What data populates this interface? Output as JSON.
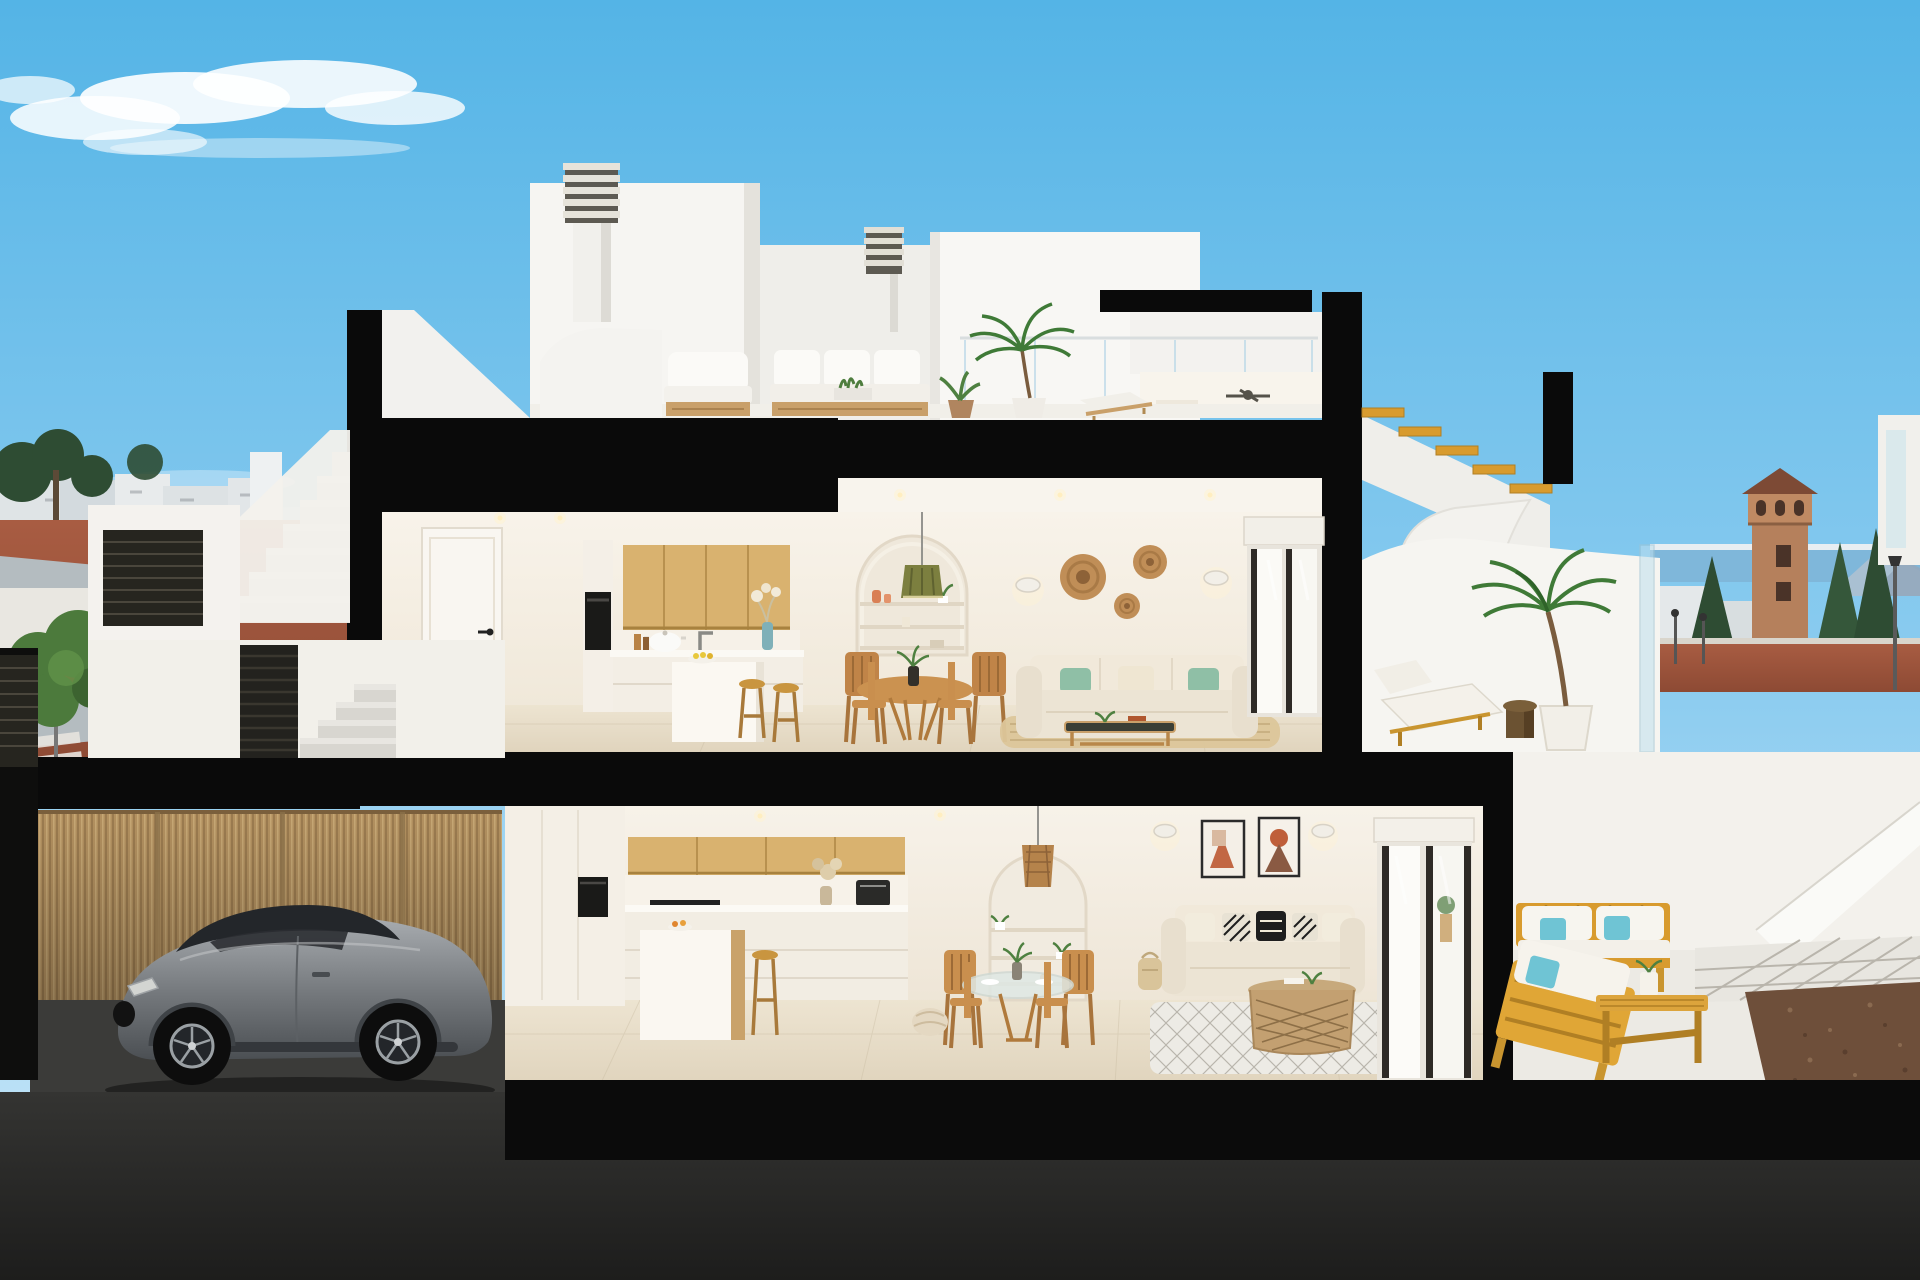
{
  "meta": {
    "title": "cutaway-cross-section-render-of-two-storey-coastal-villa",
    "canvas": {
      "width": 1920,
      "height": 1280
    }
  },
  "palette": {
    "sky_top": "#54b4e6",
    "sky_mid": "#8ecdf0",
    "sky_bottom": "#cfeaf9",
    "cloud": "#ffffff",
    "cut_black": "#0a0a0a",
    "wall_white": "#f6f5f2",
    "wall_shadow": "#e4e2dc",
    "interior_ceiling": "#f8f4ed",
    "interior_floor": "#e9dfcb",
    "wood_cabinet": "#d9b26f",
    "wood_cabinet_line": "#b8914f",
    "wood_dining": "#c08448",
    "oven_black": "#1a1a18",
    "sofa_beige": "#ece4d4",
    "sofa_back": "#f1e9da",
    "cushion_green": "#8fbfa6",
    "cushion_cream": "#efe6d2",
    "pillow_teal": "#6fc4d4",
    "pillow_black": "#1e1e1e",
    "teak_outdoor": "#d89b2e",
    "teak_dark": "#b07f24",
    "rattan": "#b5946a",
    "basket_rattan": "#c08e57",
    "rug_jute": "#dcc69a",
    "rug_white": "#edebe5",
    "reed_fence": "#b39160",
    "pavement_red": "#a2573f",
    "road_gray": "#b4bcc0",
    "sea": "#7fb7da",
    "mountain": "#a9c0d2",
    "tower_brick": "#b5805c",
    "tower_roof": "#7d4a35",
    "tree_dark": "#2e4c33",
    "tree_leaf": "#4c7a3c",
    "palm_green": "#3f7a37",
    "car_glass": "#23262a",
    "wheel_rim": "#9aa0a4",
    "glass_tint": "#bfe0ee",
    "gravel_brown": "#6e4f3a",
    "ground_dark": "#232322",
    "pendant_olive": "#7c7f3f",
    "terracotta": "#c26744",
    "louver_dark": "#26251f"
  },
  "scene": {
    "sky": {
      "clouds": [
        "large-wispy-cloud",
        "faint-low-clouds"
      ]
    },
    "rooftop": {
      "chimneys": 2,
      "penthouse_ceiling_fan": true,
      "terrace_furniture": [
        "outdoor-sofa",
        "outdoor-armchair",
        "planter-box",
        "potted-plant",
        "palm-plant",
        "sun-lounger"
      ]
    },
    "upper_floor": {
      "kitchen": [
        "white-door",
        "oven-column",
        "oak-wall-cabinets",
        "cooking-pot",
        "faucet",
        "blue-vase",
        "kitchen-island",
        "fruit-bowl",
        "bar-stools"
      ],
      "dining": [
        "round-wood-table",
        "wood-chairs",
        "table-plant",
        "olive-pendant-lamp",
        "arched-shelf-niche"
      ],
      "living": [
        "beige-sofa",
        "green-cushions",
        "glass-coffee-table",
        "jute-rug",
        "wall-sconces",
        "rattan-wall-baskets",
        "sliding-glass-door",
        "roller-blind"
      ]
    },
    "upper_right_terrace": [
      "wood-staircase",
      "curved-white-wall",
      "sun-lounger",
      "round-side-table",
      "potted-palm",
      "glass-balustrade"
    ],
    "lower_floor": {
      "kitchen": [
        "tall-white-cabinets",
        "built-in-oven",
        "oak-wall-cabinets",
        "induction-hob",
        "coffee-machine",
        "pampas-vase",
        "island-with-oak-side",
        "wood-stool"
      ],
      "dining": [
        "glass-round-table",
        "wood-chairs",
        "woven-pouf"
      ],
      "living": [
        "arched-shelf-niche",
        "rattan-pendant-lamp",
        "two-art-frames",
        "wall-sconces",
        "beige-sofa",
        "patterned-cushions",
        "rattan-coffee-table",
        "diamond-pattern-rug",
        "sliding-glass-door"
      ]
    },
    "lower_right_terrace": [
      "teak-loveseat",
      "teak-sofa",
      "teak-bench-table",
      "teal-pillows",
      "paver-path",
      "gravel-bed",
      "white-ramp",
      "street-lamp"
    ],
    "garage": [
      "reed-slat-fence",
      "grey-sports-coupe"
    ],
    "entry": [
      "exterior-stairs",
      "dark-louver-gate",
      "white-parapet",
      "louver-panel"
    ],
    "background_left": [
      "town-silhouette",
      "street-trees",
      "red-sidewalk",
      "road",
      "zebra-crossing",
      "blue-round-sign",
      "leafy-tree"
    ],
    "background_right": [
      "sea-horizon",
      "coastal-skyline",
      "watchtower",
      "conifer-trees",
      "mountains",
      "street-lamps",
      "red-sidewalk"
    ]
  }
}
